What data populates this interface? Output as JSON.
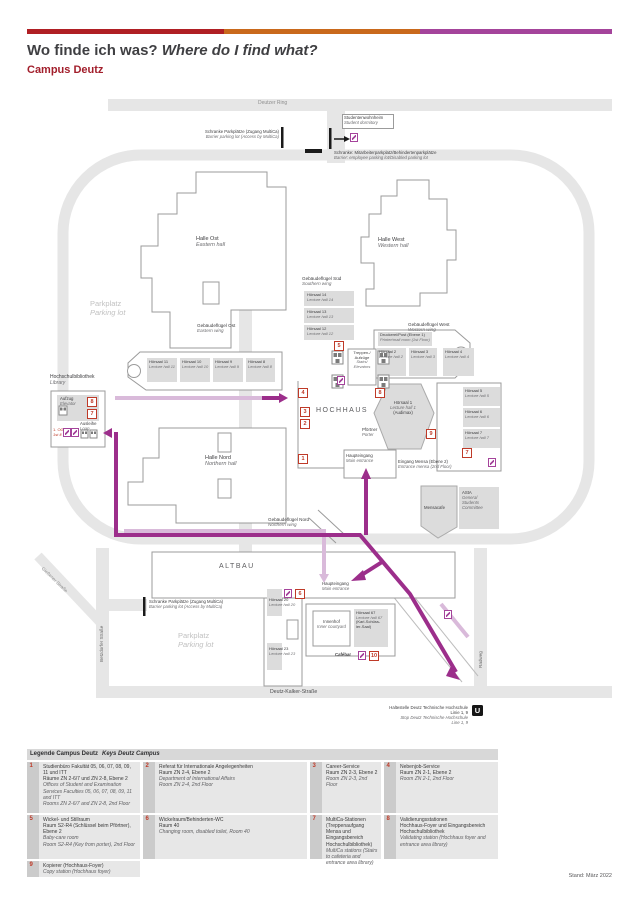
{
  "header": {
    "title_de": "Wo finde ich was? ",
    "title_en": "Where do I find what?",
    "campus": "Campus Deutz",
    "bar_colors": {
      "red": "#b01f24",
      "orange": "#c9691c",
      "purple": "#a4449b"
    }
  },
  "streets": {
    "deutzer_ring": "Deutzer Ring",
    "deutz_kalker": "Deutz-Kalker-Straße",
    "betzdorfer": "Betzdorfer Straße",
    "giessener": "Gießener Straße",
    "radweg": "Radweg"
  },
  "map": {
    "studentenwohnheim": {
      "de": "Studentenwohnheim",
      "en": "Student dormitory"
    },
    "schranke_top": {
      "de": "Schranke Parkplätze (Zugang MultiCa)",
      "en": "Barrier parking lot (Access by MultiCa)"
    },
    "schranke_mitarbeiter": {
      "de": "Schranke: Mitarbeiterparkplatz/Behindertenparkplätze",
      "en": "Barrier: employee parking lot/Disabled parking lot"
    },
    "schranke_bottom": {
      "de": "Schranke Parkplätze (Zugang MultiCa)",
      "en": "Barrier parking lot (Access by MultiCa)"
    },
    "halle_ost": {
      "de": "Halle Ost",
      "en": "Eastern hall"
    },
    "halle_west": {
      "de": "Halle West",
      "en": "Western hall"
    },
    "halle_nord": {
      "de": "Halle Nord",
      "en": "Northern hall"
    },
    "gf_sued": {
      "de": "Gebäudeflügel Süd",
      "en": "Southern wing"
    },
    "gf_ost": {
      "de": "Gebäudeflügel Ost",
      "en": "Eastern wing"
    },
    "gf_west": {
      "de": "Gebäudeflügel West",
      "en": "Western wing"
    },
    "gf_nord": {
      "de": "Gebäudeflügel Nord",
      "en": "Northern wing"
    },
    "parkplatz": {
      "de": "Parkplatz",
      "en": "Parking lot"
    },
    "hochhaus": "HOCHHAUS",
    "altbau": "ALTBAU",
    "bibliothek": {
      "de": "Hochschulbibliothek",
      "en": "Library"
    },
    "aufzug": {
      "de": "Aufzug",
      "en": "Elevator"
    },
    "ausleihe": {
      "de": "Ausleihe",
      "en": "Loan"
    },
    "og1": {
      "de": "1. OG",
      "en": "1st fl."
    },
    "druckerei": {
      "de": "Druckerei/Post (Ebene 1)",
      "en": "Printer/mail room (1st Floor)"
    },
    "treppen": {
      "de": "Treppen-/\nAufzüge",
      "en": "Stairs/\nElevators"
    },
    "pfoertner": {
      "de": "Pförtner",
      "en": "Porter"
    },
    "haupteingang": {
      "de": "Haupteingang",
      "en": "Main entrance"
    },
    "eingang_mensa": {
      "de": "Eingang Mensa (Ebene 2)",
      "en": "Entrance mensa (2nd Floor)"
    },
    "mensacafe": "Mensacafe",
    "asta": {
      "de": "AStA",
      "en": "General\nStudents\nCommittee"
    },
    "innenhof": {
      "de": "Innenhof",
      "en": "Inner courtyard"
    },
    "cafebar": "Cafébar",
    "halls": {
      "h1": {
        "de": "Hörsaal 1",
        "en": "Lecture hall 1",
        "extra": "(Audimax)"
      },
      "h2": {
        "de": "Hörsaal 2",
        "en": "Lecture hall 2"
      },
      "h3": {
        "de": "Hörsaal 3",
        "en": "Lecture hall 3"
      },
      "h4": {
        "de": "Hörsaal 4",
        "en": "Lecture hall 4"
      },
      "h5": {
        "de": "Hörsaal 5",
        "en": "Lecture hall 5"
      },
      "h6": {
        "de": "Hörsaal 6",
        "en": "Lecture hall 6"
      },
      "h7": {
        "de": "Hörsaal 7",
        "en": "Lecture hall 7"
      },
      "h8": {
        "de": "Hörsaal 8",
        "en": "Lecture hall 8"
      },
      "h9": {
        "de": "Hörsaal 9",
        "en": "Lecture hall 9"
      },
      "h10": {
        "de": "Hörsaal 10",
        "en": "Lecture hall 10"
      },
      "h11": {
        "de": "Hörsaal 11",
        "en": "Lecture hall 11"
      },
      "h12": {
        "de": "Hörsaal 12",
        "en": "Lecture hall 12"
      },
      "h13": {
        "de": "Hörsaal 13",
        "en": "Lecture hall 13"
      },
      "h14": {
        "de": "Hörsaal 14",
        "en": "Lecture hall 14"
      },
      "h20": {
        "de": "Hörsaal 20",
        "en": "Lecture hall 20"
      },
      "h23": {
        "de": "Hörsaal 23",
        "en": "Lecture hall 23"
      },
      "h67": {
        "de": "Hörsaal 67",
        "en": "Lecture hall 67",
        "extra": "(Karl-Schüss-\nler-Saal)"
      }
    }
  },
  "transit": {
    "stop_de": "Haltestelle Deutz Technische Hochschule\nLinie 1, 9",
    "stop_en": "Stop Deutz Technische Hochschule\nLine 1, 9",
    "u": "U"
  },
  "markers": {
    "m1": "1",
    "m2": "2",
    "m3": "3",
    "m4": "4",
    "m5": "5",
    "m6": "6",
    "m7": "7",
    "m8": "8",
    "m9": "9",
    "m10": "10"
  },
  "legend": {
    "title_de": "Legende Campus Deutz",
    "title_en": "Keys Deutz Campus",
    "items": [
      {
        "num": "1",
        "de": "Studienbüro Fakultät 05, 06, 07, 08, 09, 11 und ITT\nRäume ZN 2-6/7 und ZN 2-8, Ebene 2",
        "en": "Offices of Student and Examination Services Faculties 05, 06, 07, 08, 09, 11 and ITT\nRooms ZN 2-6/7 and ZN 2-8, 2nd Floor"
      },
      {
        "num": "2",
        "de": "Referat für Internationale Angelegenheiten\nRaum ZN 2-4, Ebene 2",
        "en": "Department of International Affairs\nRoom ZN 2-4, 2nd Floor"
      },
      {
        "num": "3",
        "de": "Career-Service\nRaum ZN 2-3, Ebene 2",
        "en": "Room ZN 2-3, 2nd Floor"
      },
      {
        "num": "4",
        "de": "Nebenjob-Service\nRaum ZN 2-1, Ebene 2",
        "en": "Room ZN 2-1, 2nd Floor"
      },
      {
        "num": "5",
        "de": "Wickel- und Stillraum\nRaum S2-R4 (Schlüssel beim Pförtner), Ebene 2",
        "en": "Baby-care room\nRoom S2-R4 (Key from porter), 2nd Floor"
      },
      {
        "num": "6",
        "de": "Wickelraum/Behinderten-WC\nRaum 40",
        "en": "Changing room, disabled toilet, Room 40"
      },
      {
        "num": "7",
        "de": "MultiCa-Stationen\n(Treppenaufgang Mensa und Eingangsbereich Hochschulbibliothek)",
        "en": "MultiCa stations (Stairs to cafeteria and entrance area library)"
      },
      {
        "num": "8",
        "de": "Validierungsstationen\nHochhaus-Foyer und Eingangsbereich Hochschulbibliothek",
        "en": "Validating station (Hochhaus foyer and entrance area library)"
      },
      {
        "num": "9",
        "de": "Kopierer (Hochhaus-Foyer)",
        "en": "Copy station (Hochhaus foyer)"
      }
    ]
  },
  "footer": {
    "date": "Stand: März 2022"
  }
}
